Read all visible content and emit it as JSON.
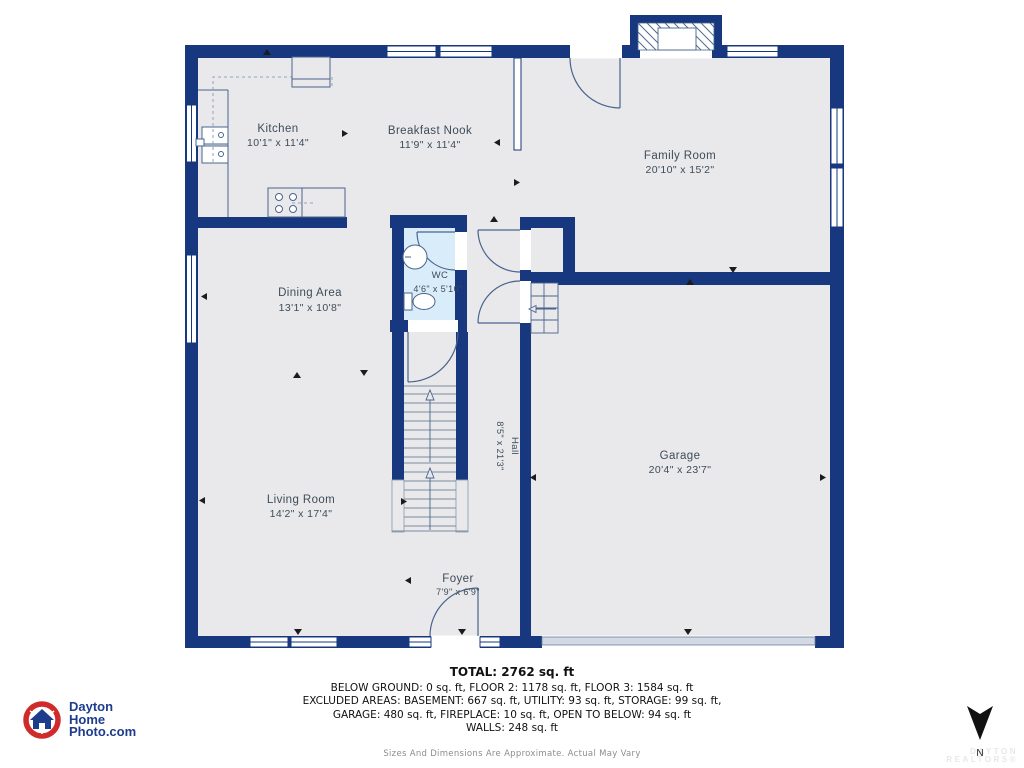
{
  "rooms": {
    "kitchen": {
      "name": "Kitchen",
      "dims": "10'1\" x 11'4\""
    },
    "breakfast_nook": {
      "name": "Breakfast Nook",
      "dims": "11'9\" x 11'4\""
    },
    "family_room": {
      "name": "Family Room",
      "dims": "20'10\" x 15'2\""
    },
    "dining_area": {
      "name": "Dining Area",
      "dims": "13'1\" x 10'8\""
    },
    "wc": {
      "name": "WC",
      "dims": "4'6\" x 5'10\""
    },
    "hall": {
      "name": "Hall",
      "dims": "8'5\" x 21'3\""
    },
    "garage": {
      "name": "Garage",
      "dims": "20'4\" x 23'7\""
    },
    "living_room": {
      "name": "Living Room",
      "dims": "14'2\" x 17'4\""
    },
    "foyer": {
      "name": "Foyer",
      "dims": "7'9\" x 6'9\""
    }
  },
  "summary": {
    "total": "TOTAL: 2762 sq. ft",
    "line1": "BELOW GROUND: 0 sq. ft, FLOOR 2: 1178 sq. ft, FLOOR 3: 1584 sq. ft",
    "line2": "EXCLUDED AREAS: BASEMENT: 667 sq. ft, UTILITY: 93 sq. ft, STORAGE: 99 sq. ft,",
    "line3": "GARAGE: 480 sq. ft, FIREPLACE: 10 sq. ft, OPEN TO BELOW: 94 sq. ft",
    "line4": "WALLS: 248 sq. ft",
    "disclaimer": "Sizes And Dimensions Are Approximate. Actual May Vary"
  },
  "logo": {
    "line1": "Dayton",
    "line2": "Home",
    "line3": "Photo.com"
  },
  "compass": {
    "label": "N"
  },
  "watermark": {
    "line1": "DAYTON",
    "line2": "REALTORS®"
  },
  "colors": {
    "wall": "#17377e",
    "floor": "#e9e9eb",
    "wc_floor": "#d9ecf9",
    "fixture_line": "#49648c",
    "logo_blue": "#1e3c8c",
    "logo_red": "#cf2b2b"
  }
}
